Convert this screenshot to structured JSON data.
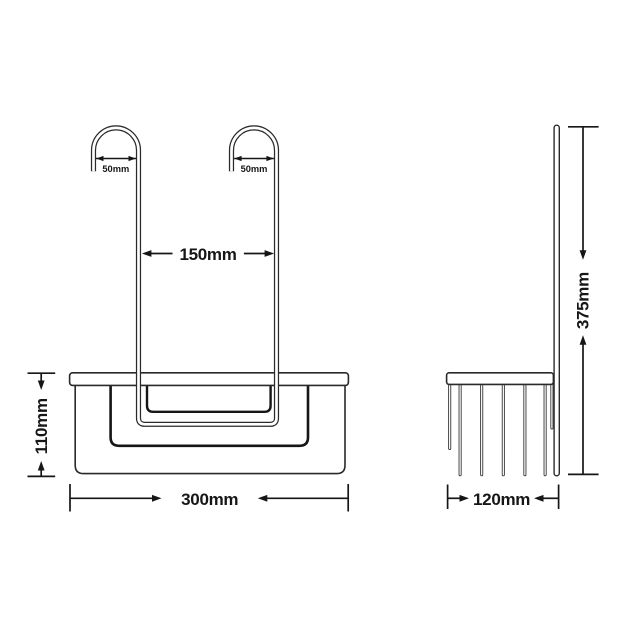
{
  "diagram": {
    "type": "technical-dimension-drawing",
    "subject": "hanging shower caddy basket with two hooks, front and side views",
    "colors": {
      "background": "#ffffff",
      "line": "#2a2a2a",
      "text": "#161616"
    },
    "front_view": {
      "dimensions": {
        "left_hook_width": "50mm",
        "right_hook_width": "50mm",
        "hook_spacing": "150mm",
        "basket_height": "110mm",
        "basket_width": "300mm"
      }
    },
    "side_view": {
      "dimensions": {
        "basket_depth": "120mm",
        "overall_height": "375mm"
      }
    }
  }
}
